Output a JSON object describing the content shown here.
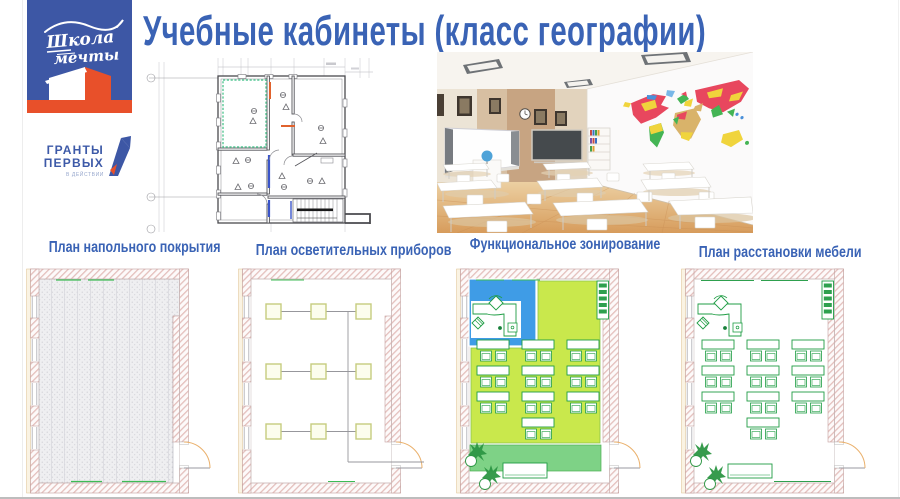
{
  "slide": {
    "title": "Учебные кабинеты (класс географии)"
  },
  "logo": {
    "school_line1": "Школа",
    "school_line2": "мечты",
    "grants_line1": "ГРАНТЫ",
    "grants_line2": "ПЕРВЫХ",
    "grants_subtitle": "В ДЕЙСТВИИ"
  },
  "plans": [
    {
      "label": "План напольного покрытия"
    },
    {
      "label": "План осветительных приборов"
    },
    {
      "label": "Функциональное зонирование"
    },
    {
      "label": "План расстановки мебели"
    }
  ],
  "colors": {
    "title_blue": "#3a63b5",
    "logo_blue": "#3d57a5",
    "logo_orange": "#e8502a",
    "zone_blue": "#3f9ce6",
    "zone_lime": "#c9e84c",
    "zone_green": "#7ed286",
    "furniture_green": "#1f9d44",
    "wall_hatch_pink": "#e4bfbc",
    "map_red": "#e8475e",
    "map_yellow": "#f0d43c",
    "map_green": "#44b454",
    "map_blue": "#4a90d9"
  }
}
